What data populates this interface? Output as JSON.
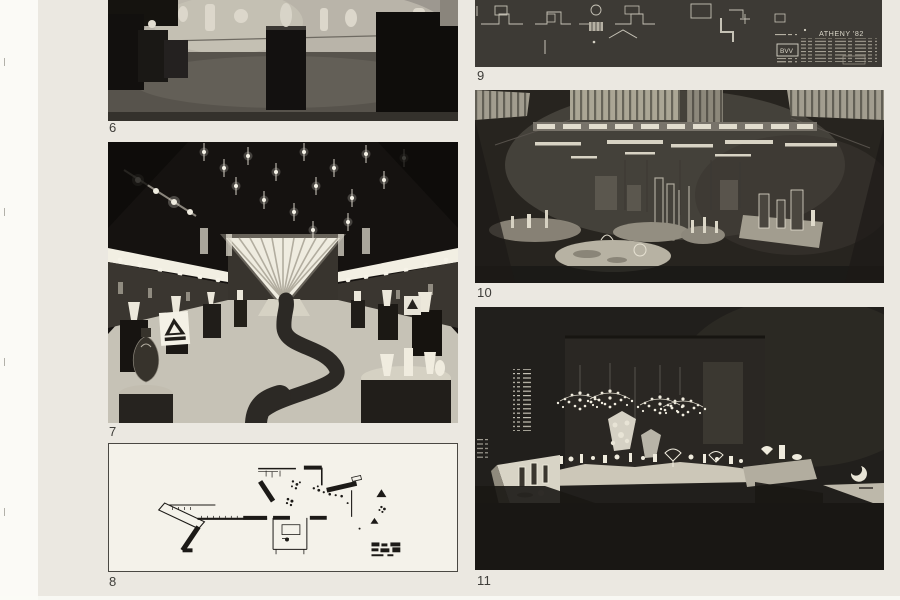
{
  "page": {
    "kind": "Scanned exhibition catalogue plate page",
    "paper_color": "#ebe8e1",
    "margin_color": "#fbfaf6"
  },
  "figures": [
    {
      "number": "6",
      "kind": "photograph",
      "description": "Exhibition hall with glass objects on dark pedestals, photo cropped by page top"
    },
    {
      "number": "7",
      "kind": "photograph",
      "description": "Long exhibition aisle: star-shaped hanging lights, fan of light rays on back wall, winding dark path between pedestals with glass vases, triangular logo signs"
    },
    {
      "number": "8",
      "kind": "floor-plan",
      "description": "Black-line exhibition floor plan on white bordered panel"
    },
    {
      "number": "9",
      "kind": "floor-plan",
      "description": "White-on-dark technical floor plan with title block, cropped by page top",
      "title_block": {
        "project": "ATHENY '82",
        "org": "BVV"
      }
    },
    {
      "number": "10",
      "kind": "photograph",
      "description": "Dark exhibition room: ceiling light grids, glassware on glowing island platforms"
    },
    {
      "number": "11",
      "kind": "photograph",
      "description": "Dark exhibition room: crystal chandeliers over lit counters of glassware, lit corner cases"
    }
  ]
}
